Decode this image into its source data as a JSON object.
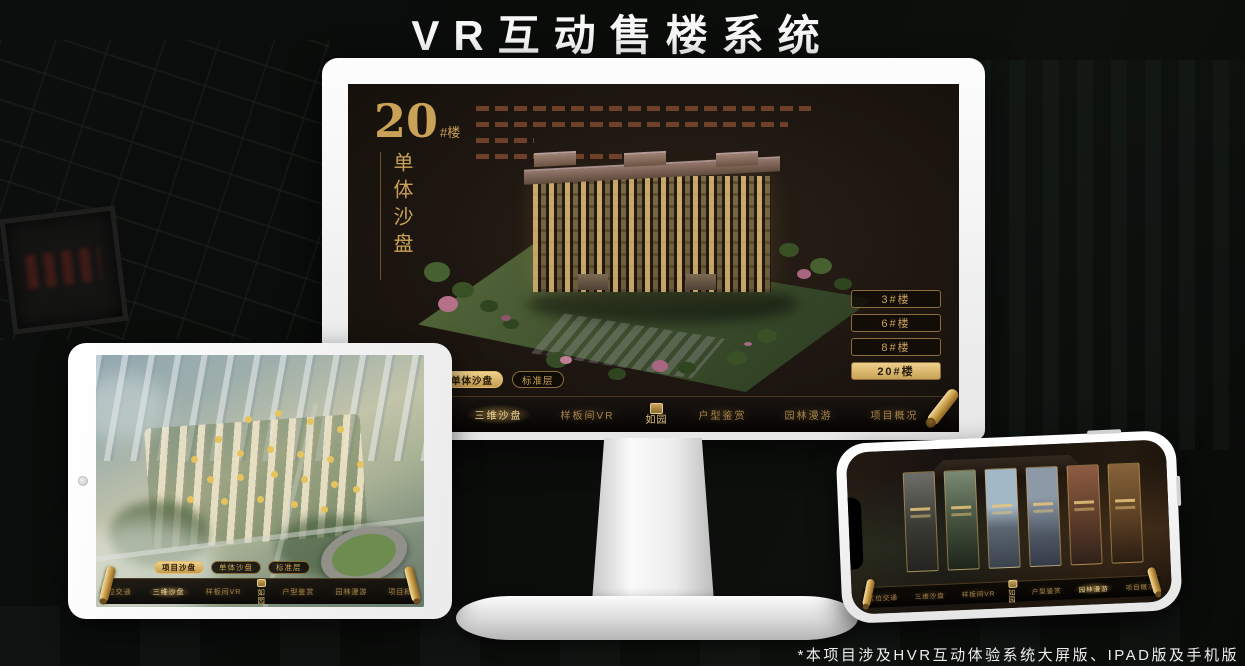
{
  "page": {
    "title": "VR互动售楼系统",
    "footnote": "*本项目涉及HVR互动体验系统大屏版、IPAD版及手机版"
  },
  "colors": {
    "gold": "#c9a257",
    "gold_bright": "#ecd08d",
    "screen_bg": "#1d1610",
    "nav_text": "#a8854a",
    "white": "#f7f7f7"
  },
  "monitor": {
    "headline": {
      "number": "20",
      "suffix": "#楼",
      "vertical_title": "单体沙盘"
    },
    "building_buttons": [
      {
        "label": "3#楼",
        "active": false
      },
      {
        "label": "6#楼",
        "active": false
      },
      {
        "label": "8#楼",
        "active": false
      },
      {
        "label": "20#楼",
        "active": true
      }
    ],
    "sub_tabs": [
      {
        "label": "项目沙盘",
        "active": false
      },
      {
        "label": "单体沙盘",
        "active": true
      },
      {
        "label": "标准层",
        "active": false
      }
    ],
    "nav": {
      "left_items": [
        "区位交通",
        "三维沙盘",
        "样板间VR"
      ],
      "right_items": [
        "户型鉴赏",
        "园林漫游",
        "项目概况"
      ],
      "active_item": "三维沙盘",
      "logo": "如园"
    }
  },
  "tablet": {
    "sub_tabs": [
      {
        "label": "项目沙盘",
        "active": true
      },
      {
        "label": "单体沙盘",
        "active": false
      },
      {
        "label": "标准层",
        "active": false
      }
    ],
    "nav": {
      "left_items": [
        "区位交通",
        "三维沙盘",
        "样板间VR"
      ],
      "right_items": [
        "户型鉴赏",
        "园林漫游",
        "项目概况"
      ],
      "active_item": "三维沙盘",
      "logo": "如园"
    }
  },
  "phone": {
    "gallery_panels": 6,
    "nav": {
      "left_items": [
        "区位交通",
        "三维沙盘",
        "样板间VR"
      ],
      "right_items": [
        "户型鉴赏",
        "园林漫游",
        "项目概况"
      ],
      "active_item": "园林漫游",
      "logo": "如园"
    }
  }
}
